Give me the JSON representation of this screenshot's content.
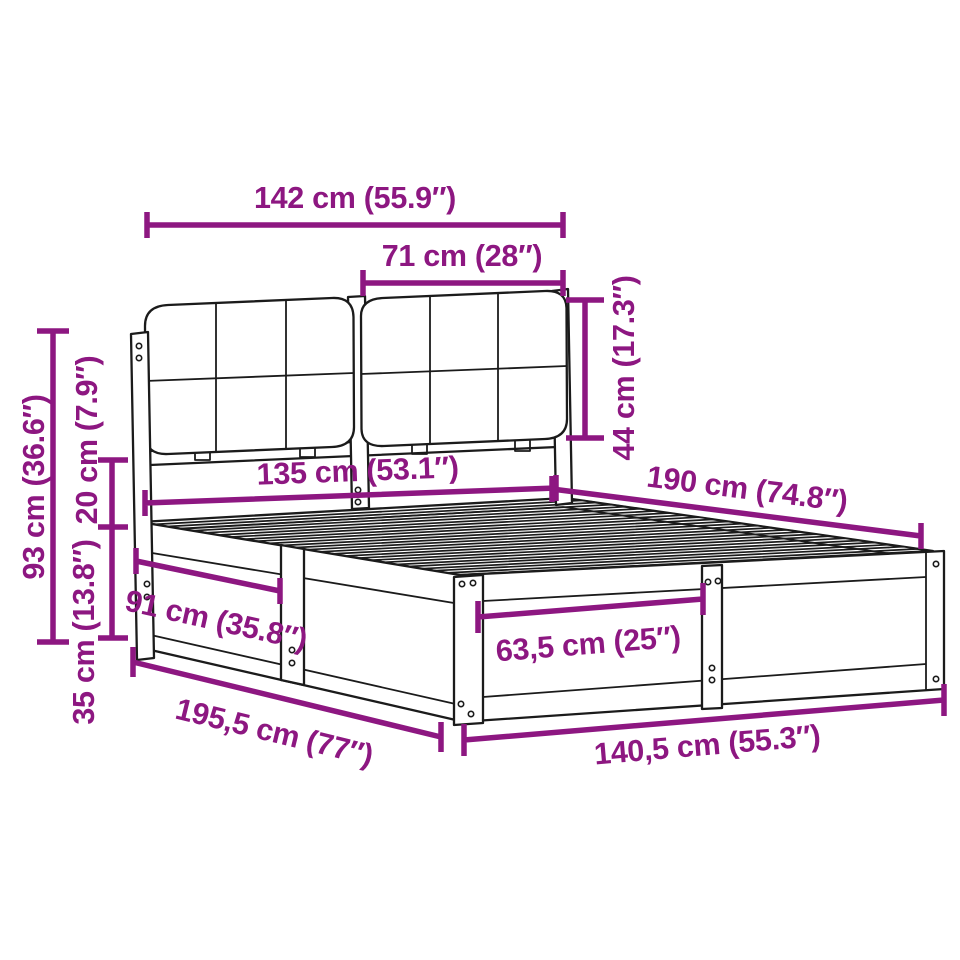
{
  "diagram": {
    "kind": "furniture-dimension-diagram",
    "product": "bed frame with slatted base and upholstered cushion headboard",
    "background_color": "#ffffff",
    "line_color": "#1b1b1b",
    "accent_color": "#8d1781"
  },
  "dimensions": [
    {
      "id": "headboard-width",
      "label": "142 cm (55.9″)",
      "cm": "142",
      "inches": "55.9"
    },
    {
      "id": "cushion-width",
      "label": "71 cm (28″)",
      "cm": "71",
      "inches": "28"
    },
    {
      "id": "cushion-height",
      "label": "44 cm (17.3″)",
      "cm": "44",
      "inches": "17.3"
    },
    {
      "id": "headboard-height",
      "label": "93 cm (36.6″)",
      "cm": "93",
      "inches": "36.6"
    },
    {
      "id": "gap-height",
      "label": "20 cm (7.9″)",
      "cm": "20",
      "inches": "7.9"
    },
    {
      "id": "frame-height",
      "label": "35 cm (13.8″)",
      "cm": "35",
      "inches": "13.8"
    },
    {
      "id": "inner-width",
      "label": "135 cm (53.1″)",
      "cm": "135",
      "inches": "53.1"
    },
    {
      "id": "inner-length",
      "label": "190 cm (74.8″)",
      "cm": "190",
      "inches": "74.8"
    },
    {
      "id": "side-section-length",
      "label": "91 cm (35.8″)",
      "cm": "91",
      "inches": "35.8"
    },
    {
      "id": "foot-section-width",
      "label": "63,5 cm (25″)",
      "cm": "63,5",
      "inches": "25"
    },
    {
      "id": "total-length",
      "label": "195,5 cm (77″)",
      "cm": "195,5",
      "inches": "77"
    },
    {
      "id": "total-width",
      "label": "140,5 cm (55.3″)",
      "cm": "140,5",
      "inches": "55.3"
    }
  ]
}
